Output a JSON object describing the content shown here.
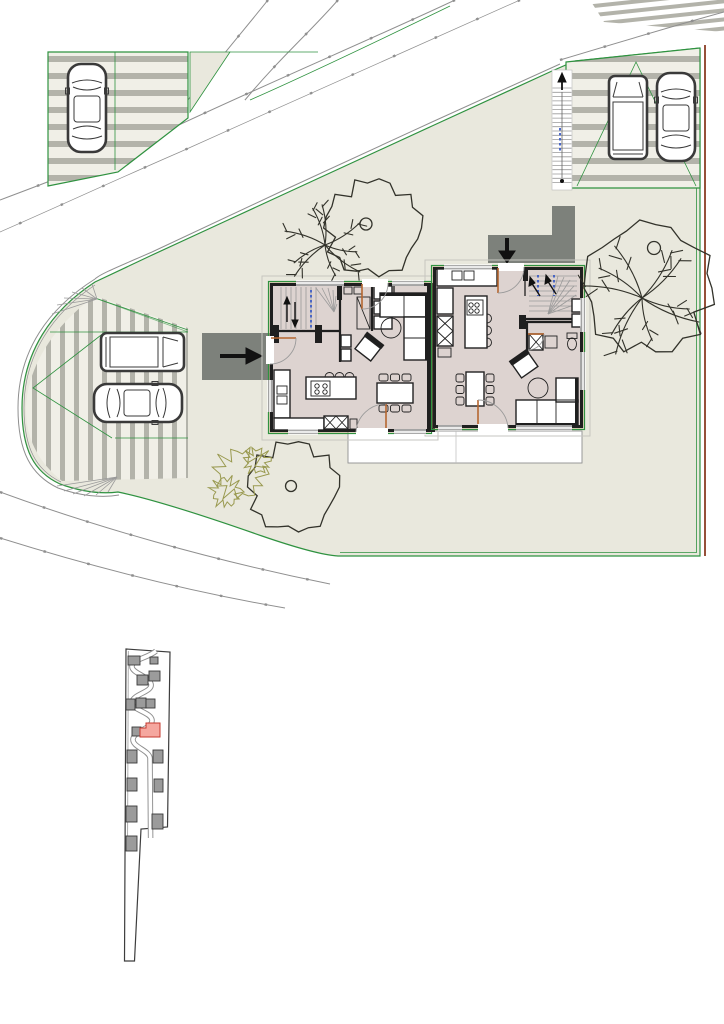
{
  "colors": {
    "paper": "#ffffff",
    "grass": "#e9e8dd",
    "parking": "#f0efe7",
    "stripe": "#b3b3aa",
    "road_line": "#8f8f8f",
    "boundary_green": "#2f9240",
    "boundary_brown": "#96503a",
    "path_dark": "#7d817b",
    "arrow_black": "#111111",
    "floor": "#ddd3d0",
    "wall": "#1f1f1f",
    "wood": "#c79d6b",
    "door_leaf": "#b5662f",
    "arc_gray": "#9a9a9a",
    "furniture": "#222222",
    "tree_line": "#32322a",
    "shrub_olive": "#99994f",
    "overhang": "#c6c6c0",
    "terrace_line": "#909090",
    "loc_outline": "#3d3d3d",
    "loc_building": "#9b9b9b",
    "loc_building_edge": "#3a3a3a",
    "loc_road": "#8f8f8f",
    "plot_pink": "#f5a79f",
    "plot_pink_edge": "#c6392f",
    "blue_mark": "#3b5bc4"
  },
  "icons": [
    {
      "name": "entry-arrow-left-house",
      "glyph": "→"
    },
    {
      "name": "entry-arrow-right-house",
      "glyph": "↓"
    },
    {
      "name": "exterior-stair-arrow",
      "glyph": "↑"
    }
  ],
  "site": {
    "houses": 2,
    "cars": 5,
    "trees": 4,
    "shrubs": 1,
    "parking_areas": 3
  },
  "locator": {
    "building_count": 16,
    "highlighted_plot_color": "#f5a79f"
  }
}
